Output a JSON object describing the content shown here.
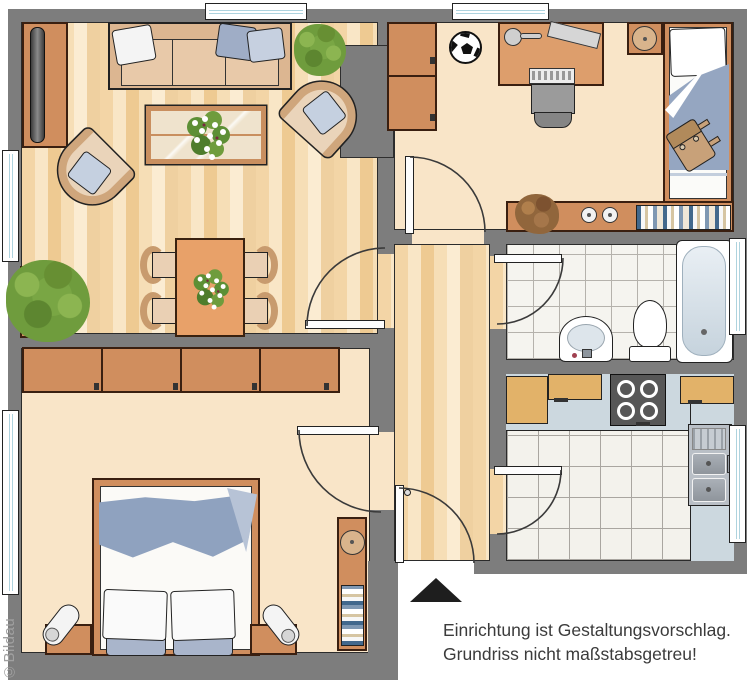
{
  "notice": {
    "line1": "Einrichtung ist Gestaltungsvorschlag.",
    "line2": "Grundriss nicht maßstabsgetreu!"
  },
  "watermark": "©Bildau",
  "palette": {
    "wall": "#7d7d7d",
    "floor_parquet": "#f3d5a6",
    "floor_plain": "#f9e5c8",
    "furniture_orange": "#d08e5e",
    "kitchen_wood": "#e2b269",
    "counter_blue": "#ccd8df",
    "textile_blue": "#8fa2bf",
    "plant_green": "#6f9c3d",
    "bath_tile": "#f5f4ef",
    "north_arrow": "#1e1e1e",
    "notice_text": "#3b3b3b",
    "watermark_gray": "#a0a0a0"
  }
}
